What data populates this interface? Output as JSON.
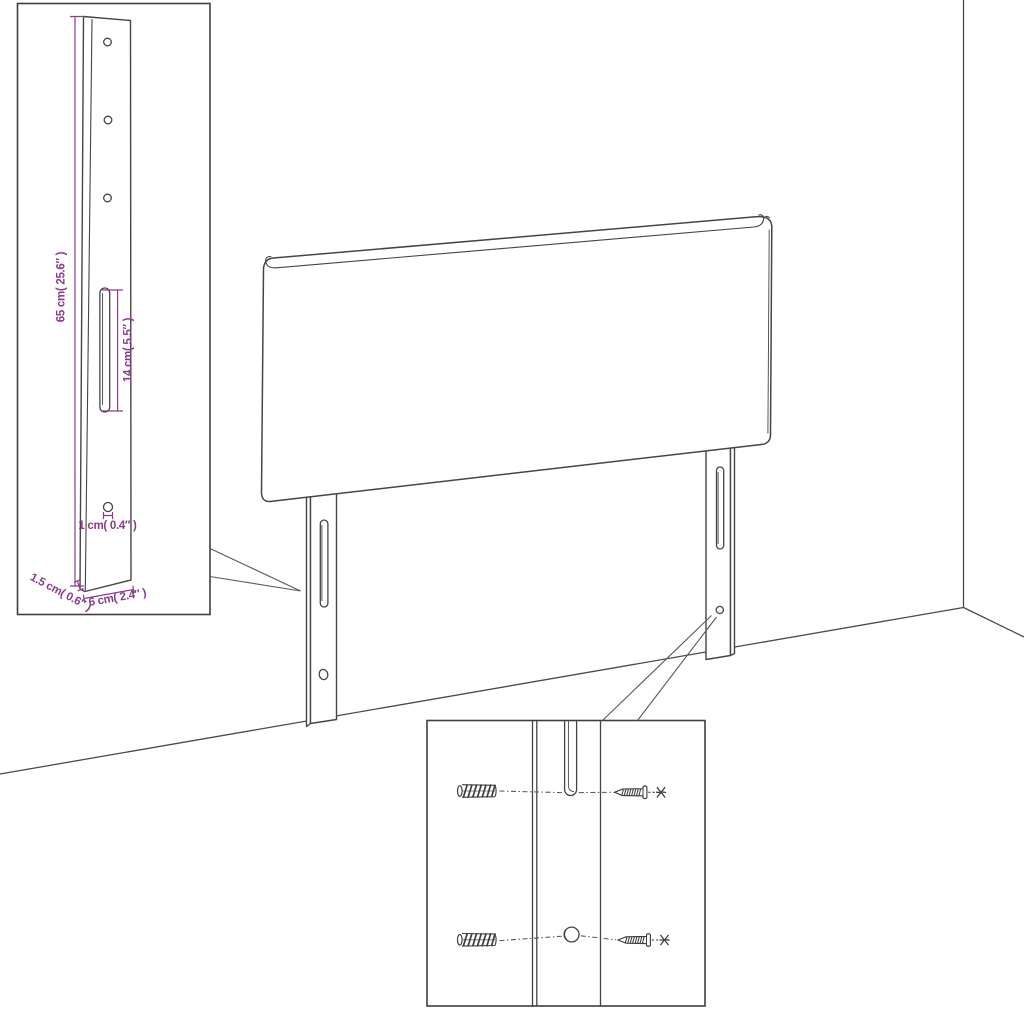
{
  "diagram": {
    "title": "headboard-assembly-diagram",
    "colors": {
      "line": "#454545",
      "dimension": "#8a3b8a",
      "background": "#ffffff"
    },
    "left_inset": {
      "part": "headboard-leg-post",
      "hole_count_top": 3,
      "dimensions": {
        "post_height": "65 cm( 25.6″ )",
        "slot_length": "14 cm( 5.5″ )",
        "hole_diameter": "1 cm( 0.4″ )",
        "post_thickness": "1.5 cm( 0.6″ )",
        "post_width": "6 cm( 2.4″ )"
      }
    },
    "main_view": {
      "part": "headboard-with-two-legs",
      "environment": "room-corner"
    },
    "bottom_inset": {
      "part": "wall-mounting-detail",
      "hardware": [
        "wall-plug",
        "screw"
      ],
      "rows": 2
    }
  }
}
